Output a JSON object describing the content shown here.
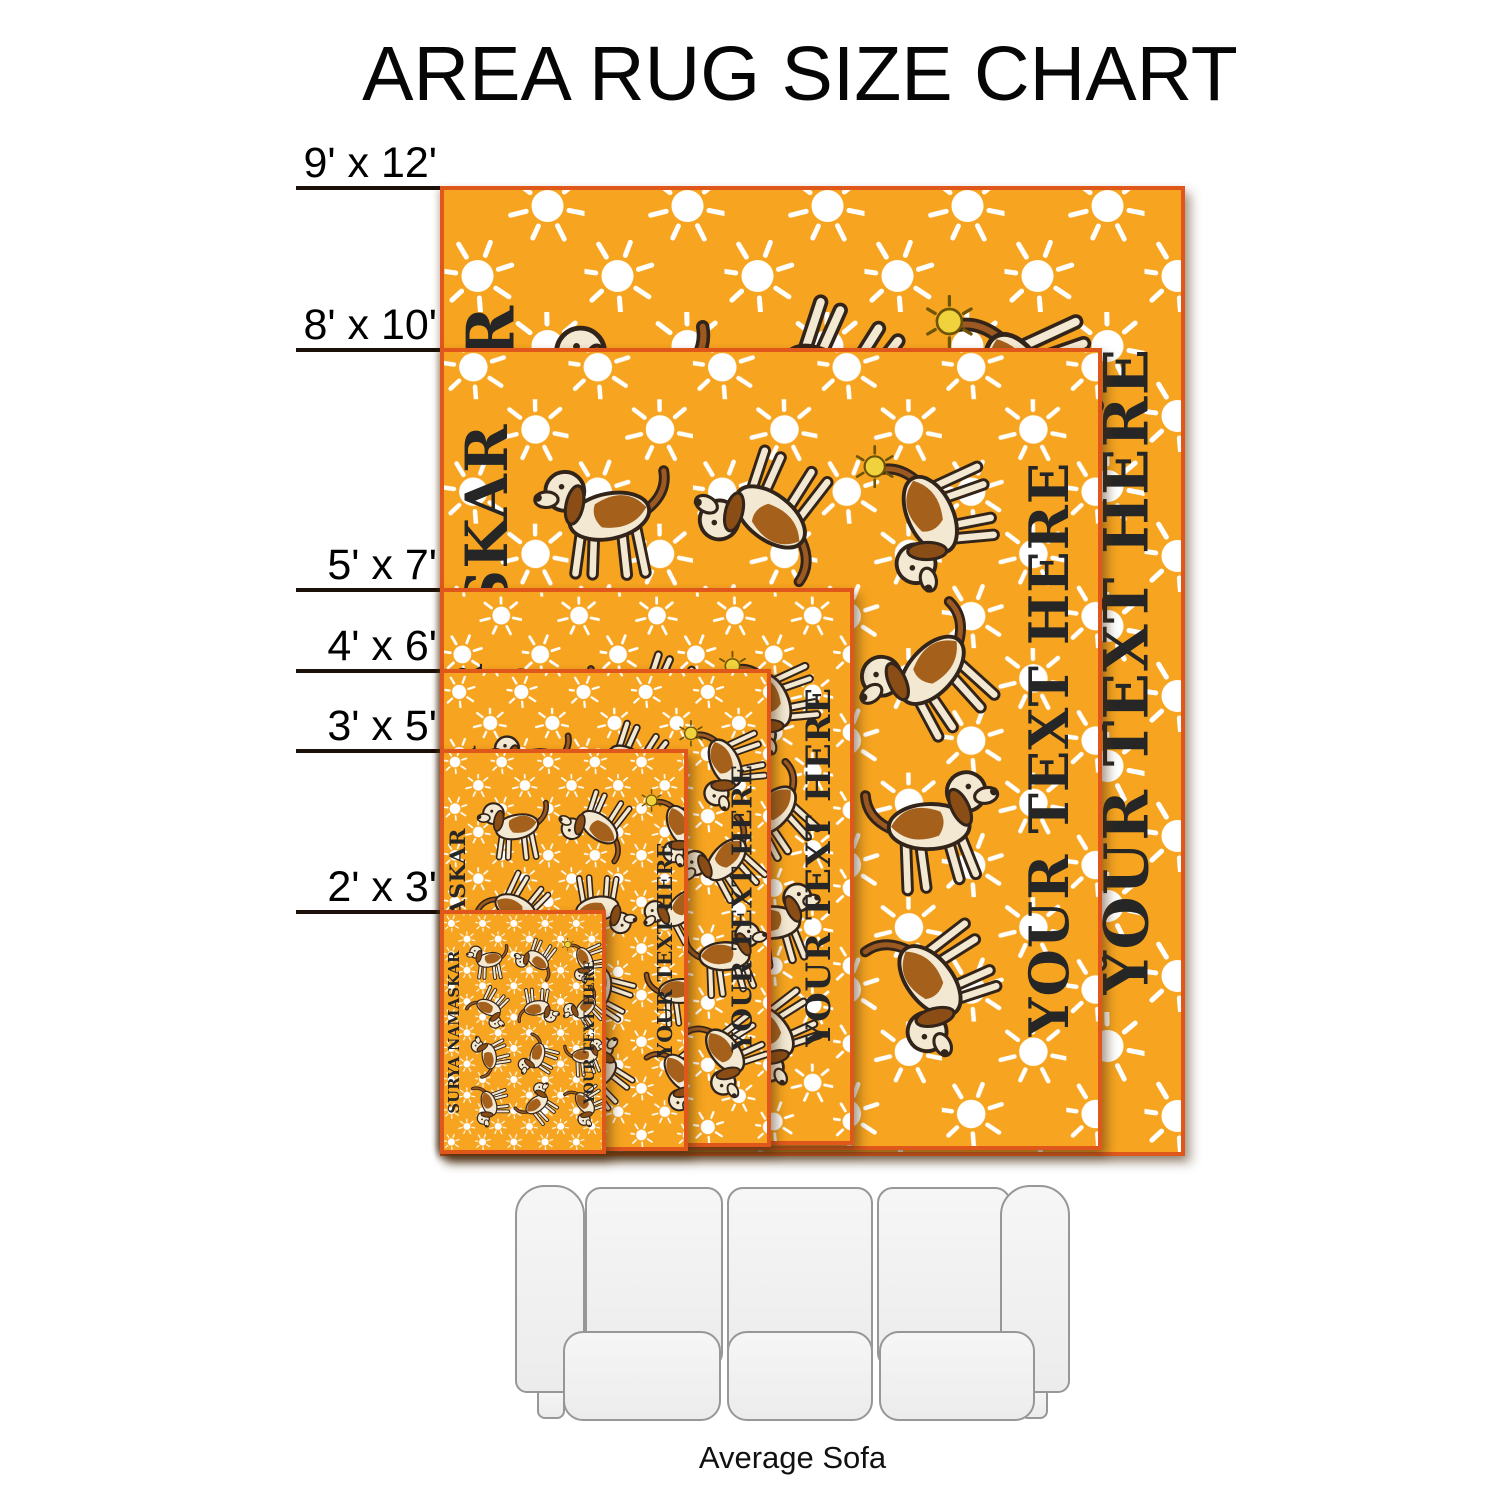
{
  "page_title": "AREA RUG SIZE CHART",
  "size_labels": [
    {
      "id": "9x12",
      "label": "9' x 12'"
    },
    {
      "id": "8x10",
      "label": "8' x 10'"
    },
    {
      "id": "5x7",
      "label": "5' x 7'"
    },
    {
      "id": "4x6",
      "label": "4' x 6'"
    },
    {
      "id": "3x5",
      "label": "3' x 5'"
    },
    {
      "id": "2x3",
      "label": "2' x 3'"
    }
  ],
  "rug_design": {
    "pattern_title": "SURYA NAMASKAR",
    "custom_text": "YOUR TEXT HERE",
    "motif": "yoga-beagle-dogs-with-sunbursts",
    "dog_count": 12,
    "colors": {
      "background": "#F7A520",
      "border": "#E0571B",
      "sun": "#FFFFFF",
      "accent_sun": "#F0D23C",
      "text": "#262626",
      "dog_body": "#F3E8D2",
      "dog_patch": "#A5611C",
      "dog_ear": "#8A4D16",
      "dog_outline": "#33241A"
    },
    "dog_poses": [
      "rotate(-10,50,50)",
      "translate(100,0) scale(-1,1) rotate(18,50,50)",
      "rotate(-55,50,50)",
      "rotate(88,50,50)",
      "translate(100,0) scale(-1,1) rotate(-42,50,50)",
      "rotate(24,50,50)",
      "rotate(-90,50,50)",
      "translate(100,0) scale(-1,1) rotate(62,50,50)",
      "rotate(-28,50,50)",
      "translate(100,0) scale(-1,1) rotate(-78,50,50)",
      "rotate(52,50,50)",
      "rotate(-15,50,50)"
    ]
  },
  "sofa": {
    "label": "Average Sofa"
  }
}
